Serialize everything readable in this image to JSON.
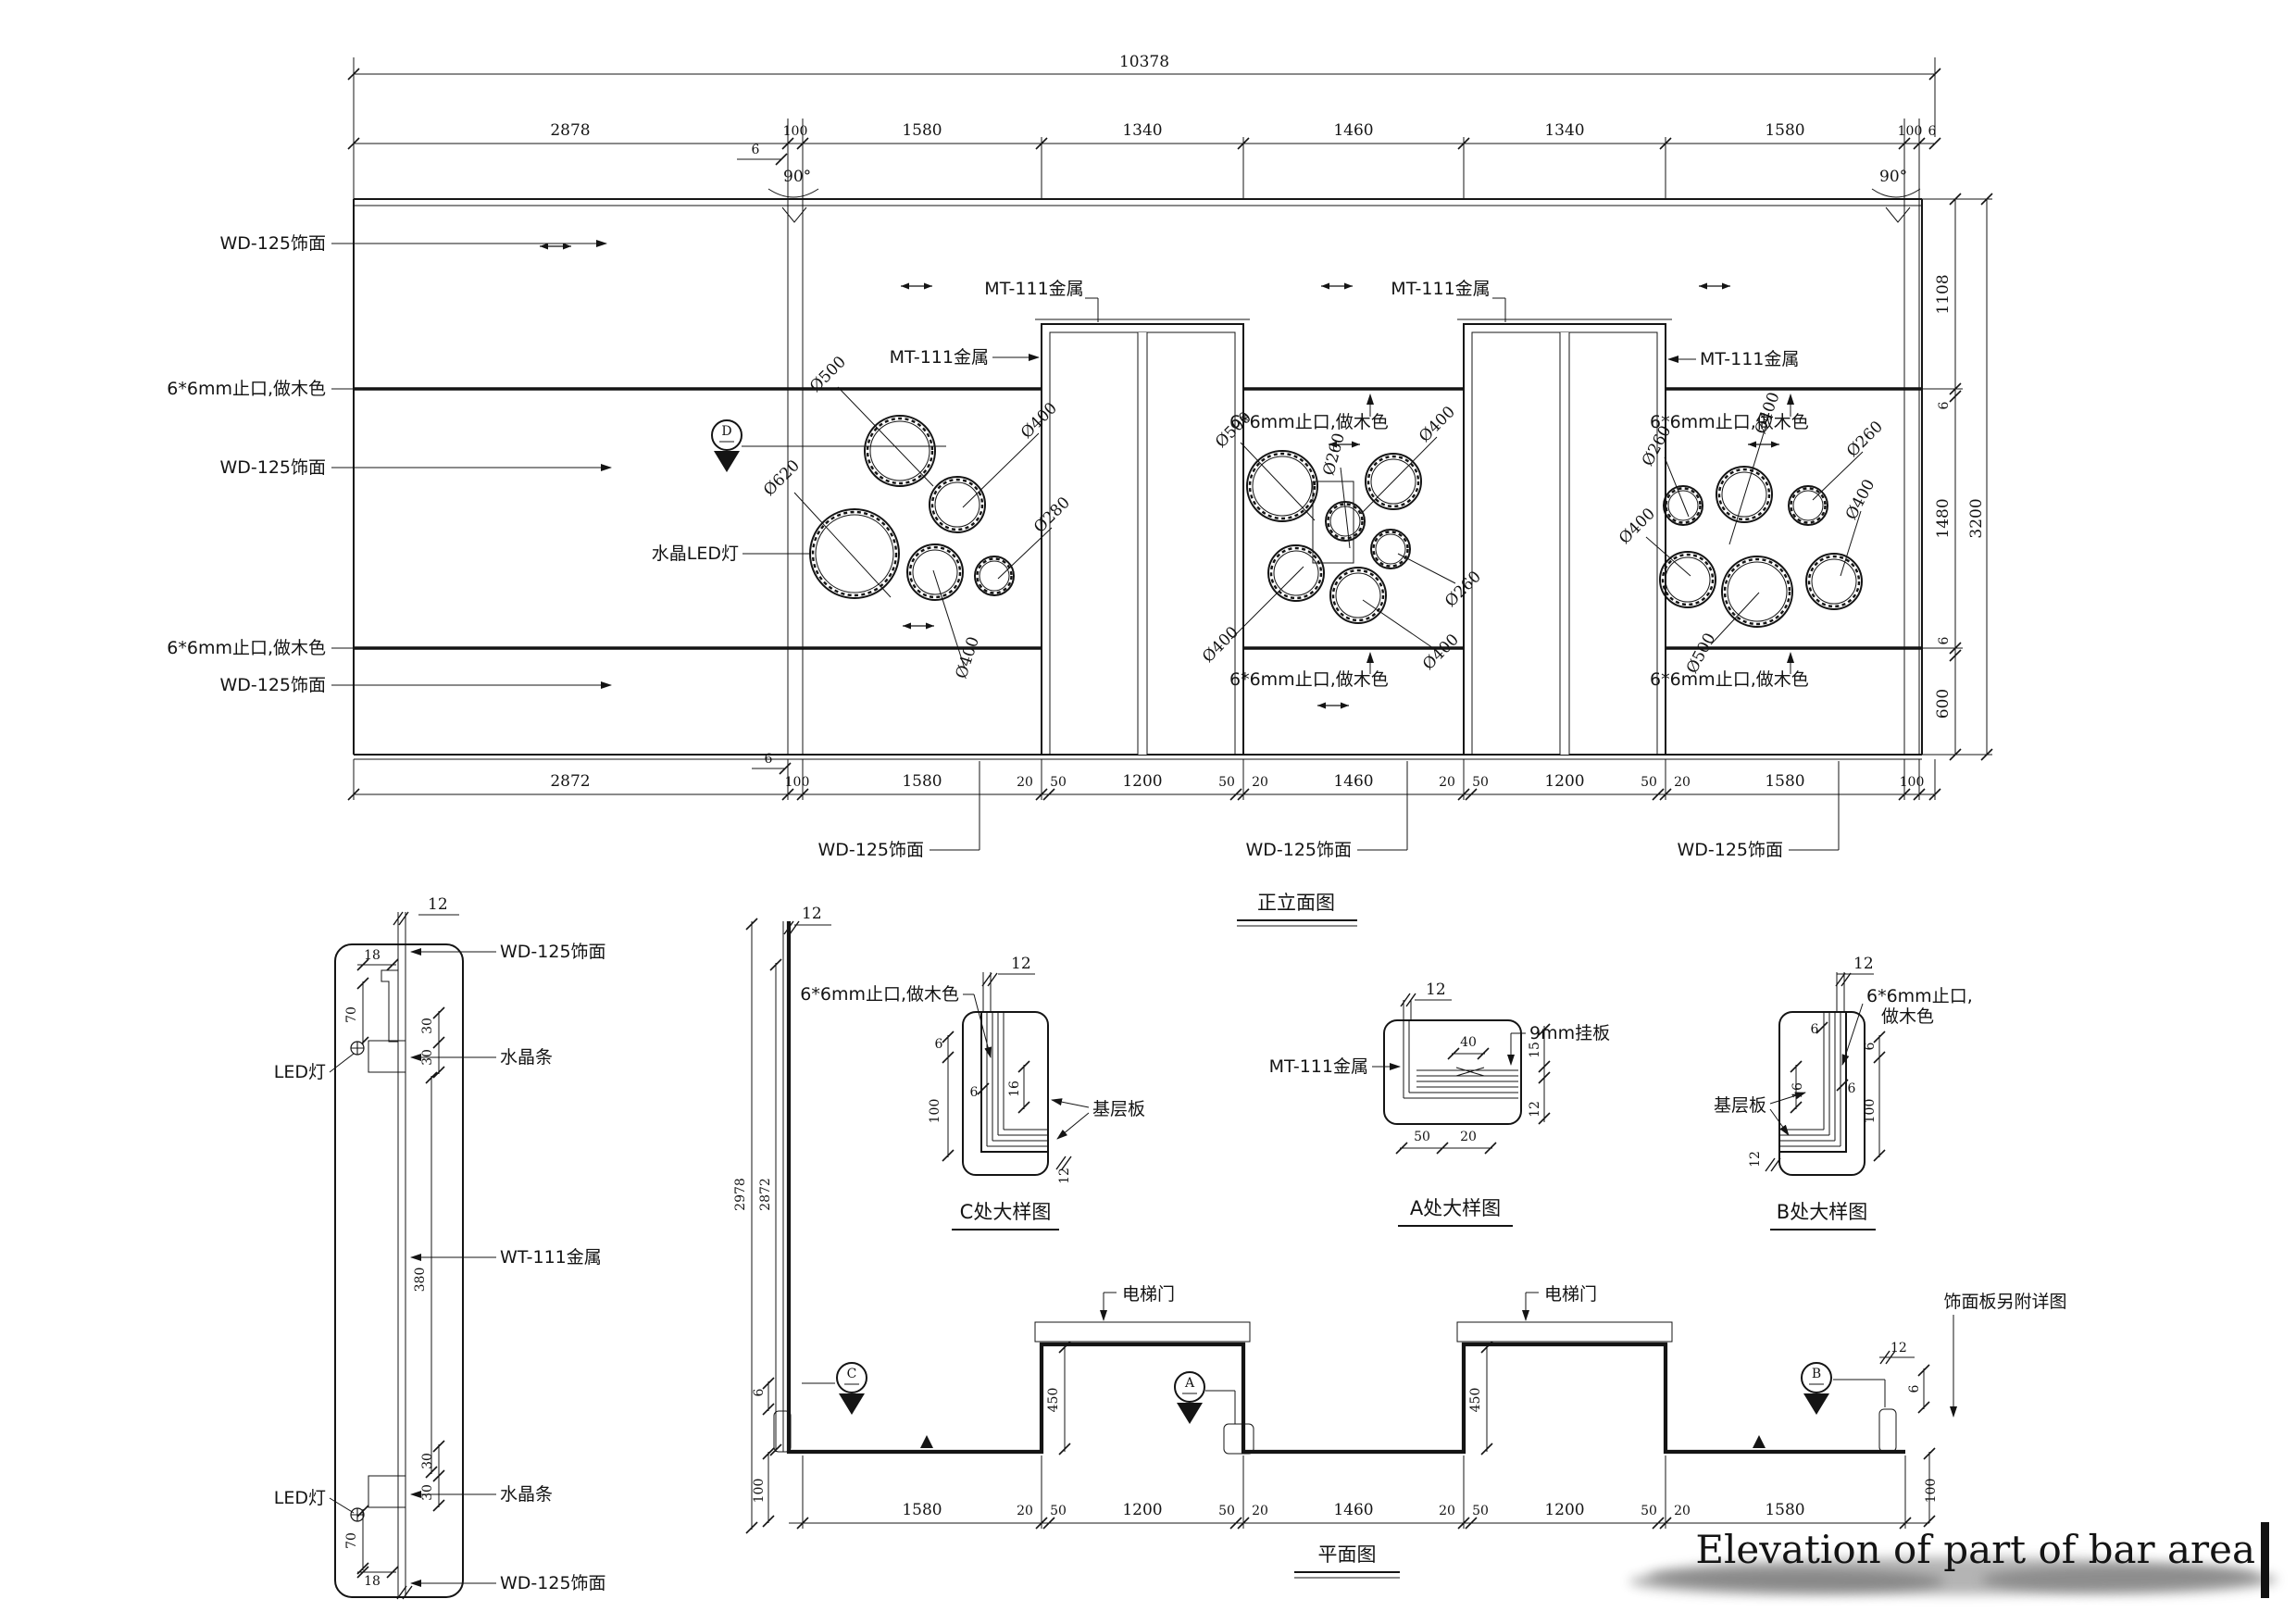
{
  "sheet": {
    "title": "Elevation of part of bar area"
  },
  "titles": {
    "elevation": "正立面图",
    "plan": "平面图",
    "detail_c": "C处大样图",
    "detail_a": "A处大样图",
    "detail_b": "B处大样图"
  },
  "labels": {
    "wd125": "WD-125饰面",
    "zhikou": "6*6mm止口,做木色",
    "zhikou_l1": "6*6mm止口,",
    "zhikou_l2": "做木色",
    "mt111": "MT-111金属",
    "wt111": "WT-111金属",
    "crystal_led": "水晶LED灯",
    "crystal_strip": "水晶条",
    "led": "LED灯",
    "base_board": "基层板",
    "hang_board": "9mm挂板",
    "elevator_door": "电梯门",
    "finish_note": "饰面板另附详图"
  },
  "markers": {
    "d": "D",
    "c": "C",
    "a": "A",
    "b": "B"
  },
  "dia": {
    "d620": "Ø620",
    "d500": "Ø500",
    "d400": "Ø400",
    "d280": "Ø280",
    "d260": "Ø260"
  },
  "edims": {
    "total": "10378",
    "angle": "90°",
    "six": "6",
    "top": [
      "2878",
      "100",
      "1580",
      "1340",
      "1460",
      "1340",
      "1580",
      "100",
      "6"
    ],
    "right": [
      "1108",
      "6",
      "1480",
      "3200",
      "6",
      "600"
    ],
    "bottom": [
      "2872",
      "6",
      "100",
      "1580",
      "20",
      "50",
      "1200",
      "50",
      "20",
      "1460",
      "20",
      "50",
      "1200",
      "50",
      "20",
      "1580",
      "100"
    ]
  },
  "sdims": {
    "d12": "12",
    "d18": "18",
    "d70": "70",
    "d30": "30",
    "d380": "380"
  },
  "ddims": {
    "d6": "6",
    "d12": "12",
    "d16": "16",
    "d100": "100",
    "d40": "40",
    "d15": "15",
    "d50": "50",
    "d20": "20"
  },
  "pdims": {
    "v_outer": "2978",
    "v_inner": "2872",
    "d450": "450",
    "d12": "12",
    "d6": "6",
    "d100": "100",
    "bottom": [
      "1580",
      "20",
      "50",
      "1200",
      "50",
      "20",
      "1460",
      "20",
      "50",
      "1200",
      "50",
      "20",
      "1580"
    ]
  }
}
